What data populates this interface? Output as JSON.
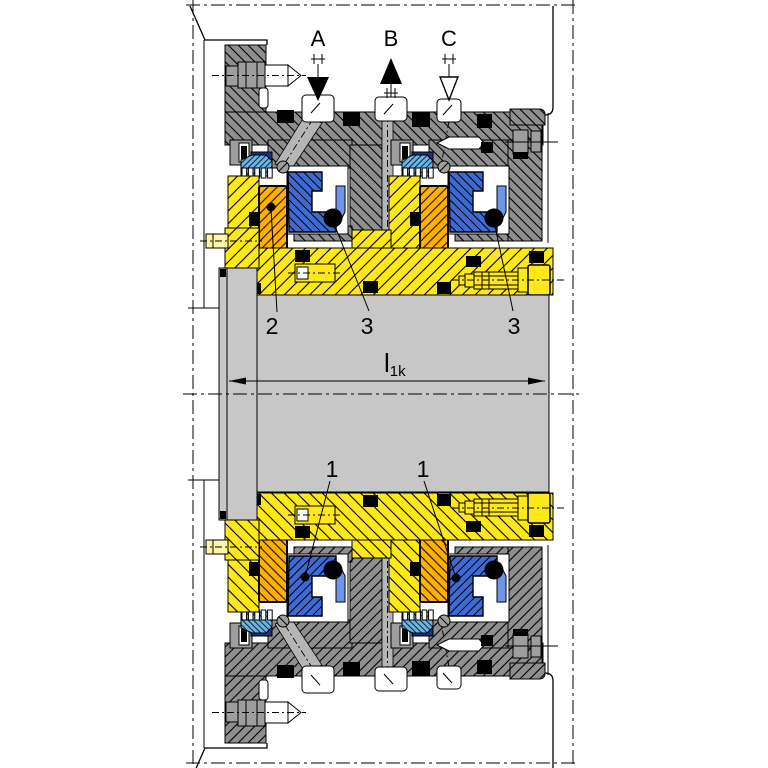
{
  "figure": {
    "type": "technical-sectional-drawing",
    "subject": "dual cartridge mechanical seal assembly on a shaft",
    "connections": [
      {
        "label": "A",
        "arrow": "filled-down"
      },
      {
        "label": "B",
        "arrow": "filled-up"
      },
      {
        "label": "C",
        "arrow": "outline-down"
      }
    ],
    "callouts": {
      "rotating_ring": "2",
      "oring_left": "3",
      "oring_right": "3",
      "seat_left": "1",
      "seat_right": "1"
    },
    "dimension": {
      "base": "l",
      "subscript": "1k"
    },
    "colors": {
      "housing_hatch_gray": "#8f8f8f",
      "detail_gray": "#9e9e9e",
      "channel_gray": "#b5b5b5",
      "shaft_gray": "#c7c7c7",
      "sleeve_yellow": "#ffe81a",
      "pale_yellow": "#fff4a8",
      "ring_orange": "#ffb000",
      "ring_blue": "#3f6ad4",
      "wedge_blue": "#6d95e8",
      "spring_light_blue": "#6ab4e6",
      "navy_blue": "#1a2f86"
    }
  }
}
